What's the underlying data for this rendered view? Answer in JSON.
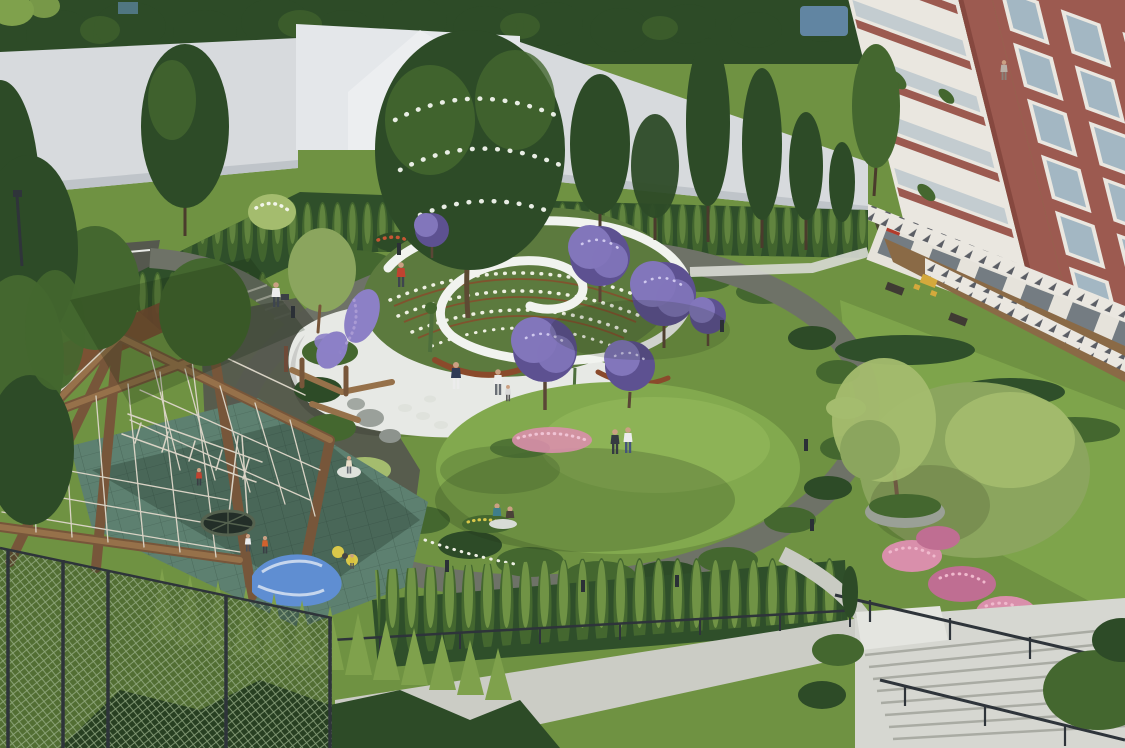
{
  "image_type": "3D architectural landscape rendering, aerial view of residential courtyard park",
  "visible_text": "none",
  "scene": {
    "elements": [
      {
        "name": "backdrop-wall",
        "label": "white perimeter wall with dark woodland behind"
      },
      {
        "name": "access-road",
        "label": "asphalt access road with white curbs, upper left"
      },
      {
        "name": "spiral-rose-garden",
        "label": "white spiral path winding through terraced rose beds with corten edges"
      },
      {
        "name": "garden-plaza",
        "label": "white paved plaza with stepping stones and boulders"
      },
      {
        "name": "loop-footpath",
        "label": "dark asphalt loop path circling the garden with bollard lights"
      },
      {
        "name": "central-blossom-tree",
        "label": "large white-blossoming tree at garden center"
      },
      {
        "name": "purple-flowering-trees",
        "label": "purple flowering ornamental trees",
        "count": 6
      },
      {
        "name": "lavender-beds",
        "label": "purple lavender drifts on west edge"
      },
      {
        "name": "lawn-mound",
        "label": "sunlit grass mound with pink flower bed and seated visitors"
      },
      {
        "name": "playground",
        "label": "timber climbing frame with rope nets, nest swing, blue-white play hill, spring toys on teal rubber surface"
      },
      {
        "name": "apartment-building",
        "label": "red brick apartment block, white window frames, glazed balconies with topiary, ground-floor terraces, zigzag balustrade bands"
      },
      {
        "name": "tree-planter",
        "label": "round concrete planter with multi-stem tree"
      },
      {
        "name": "rhododendrons",
        "label": "pink rhododendron shrubs near stairs"
      },
      {
        "name": "garden-stairs",
        "label": "wide stone stairs with dark metal railings, lower right"
      },
      {
        "name": "chain-link-fence",
        "label": "green chain-link fence, lower left"
      },
      {
        "name": "columnar-hedge-row",
        "label": "row of columnar hornbeams above lower sidewalk"
      },
      {
        "name": "conifer-row",
        "label": "row of young conifers along south boundary"
      },
      {
        "name": "sidewalk",
        "label": "light sidewalk on lower street level"
      },
      {
        "name": "path-lights",
        "label": "bollard path lights",
        "count": 8
      },
      {
        "name": "people",
        "label": "visitors in the park",
        "adults": 9,
        "children": 6
      }
    ]
  },
  "palette": {
    "lawn": "#6f9242",
    "lawnLight": "#82a94e",
    "lawnShade": "#4e7030",
    "treeDark": "#2d4b27",
    "treeMid": "#44672f",
    "treeLight": "#7fa14c",
    "olive": "#8ba55e",
    "treeBright": "#a4bc6e",
    "wall": "#d7dadd",
    "wallBright": "#e4e7ea",
    "wallShade": "#bfc4c9",
    "hedgeDark": "#2f4f2a",
    "copper": "#7c4b33",
    "pathDark": "#6e7267",
    "spiralWhite": "#f1f3ef",
    "plaza": "#e7e9e5",
    "stone": "#dfe2dc",
    "roseBed": "#5c7a3e",
    "corten": "#8a4a2b",
    "purple": "#8276bb",
    "purpleDark": "#5d5191",
    "lavender": "#8c80c6",
    "pink": "#d98fab",
    "pinkDark": "#bf6e92",
    "redFlower": "#c65634",
    "yellowFlower": "#d9c84a",
    "wood": "#96714a",
    "woodDark": "#77563a",
    "rope": "#d9d3c5",
    "rubber": "#5d8070",
    "rubberShade": "#41604f",
    "tarp": "#5f8ed2",
    "buildingRed": "#9c5a50",
    "buildingRedDark": "#86483f",
    "trim": "#eae7e0",
    "glass": "#a3b7c3",
    "stairs": "#d6d7d1",
    "railing": "#2e343a",
    "planter": "#9aa096",
    "road": "#55584e",
    "deck": "#8a6a46",
    "sidewalk": "#cbccc5",
    "skin": "#caa083",
    "mesh": "#9fb58f",
    "shirtRed": "#c14330",
    "shirtWhite": "#ececec",
    "shirtNavy": "#2f3a55",
    "shirtTeal": "#3f7e8a",
    "shirtOrange": "#d2622e",
    "shirtYellow": "#d9c13f",
    "pantsDark": "#3e454e",
    "denim": "#44557a"
  }
}
